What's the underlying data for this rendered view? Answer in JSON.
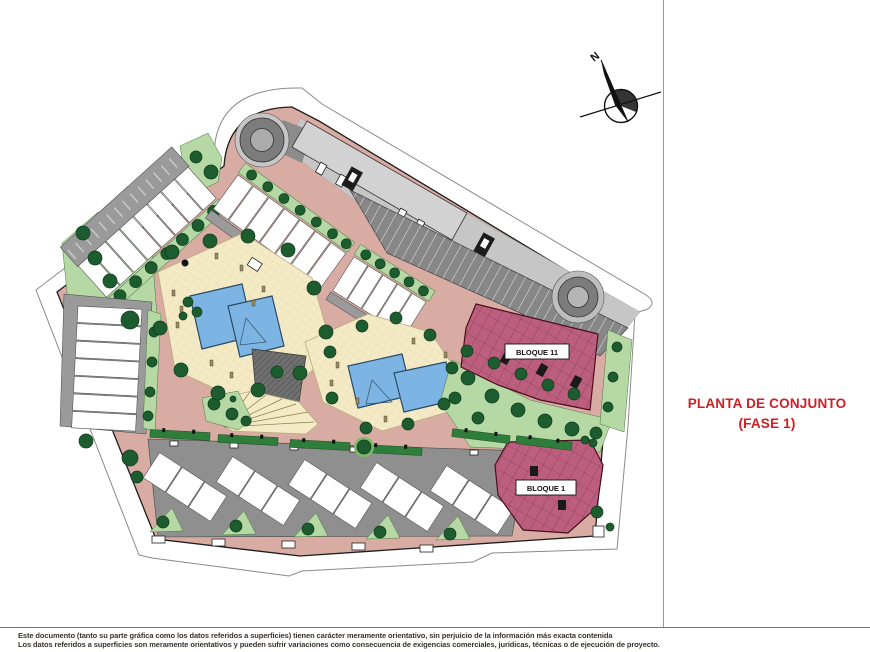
{
  "page": {
    "title_line1": "PLANTA DE CONJUNTO",
    "title_line2": "(FASE 1)",
    "disclaimer_line1": "Este documento (tanto su parte gráfica como los datos referidos a superficies) tienen carácter meramente orientativo, sin perjuicio de la información más exacta contenida",
    "disclaimer_line2": "Los datos referidos a superficies son meramente orientativos y pueden sufrir variaciones como consecuencia de exigencias comerciales, jurídicas, técnicas o de ejecución de proyecto."
  },
  "plan": {
    "labels": {
      "bloque11": "BLOQUE 11",
      "bloque1": "BLOQUE 1"
    },
    "compass_label": "N"
  },
  "colors": {
    "title_red": "#cd2024",
    "road_pink": "#d8aca3",
    "parking_dark": "#878787",
    "parking_light": "#c6c6c6",
    "green_light": "#b5d8a4",
    "green_tree": "#1d5c2e",
    "green_hedge": "#2e7d3a",
    "courtyard_cream": "#f4ebc6",
    "pool_blue": "#7cb5e3",
    "bloque_maroon": "#bc5f7e",
    "disclaimer_text": "#3a332c"
  }
}
